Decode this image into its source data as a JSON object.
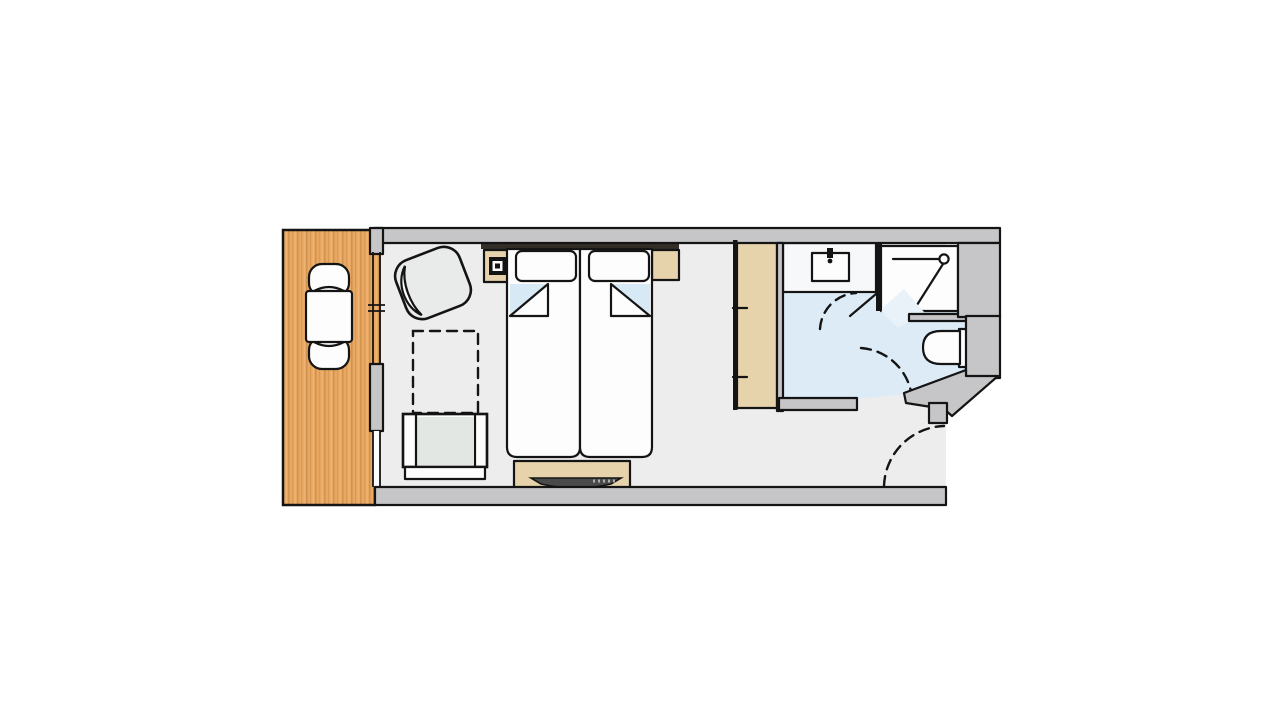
{
  "canvas": {
    "width": 1280,
    "height": 720,
    "background": "#ffffff"
  },
  "colors": {
    "wall": "#c6c6c8",
    "wood": "#e9a862",
    "wood_stripe": "#d09350",
    "wood_light": "#f0b272",
    "room_floor": "#ededee",
    "bathroom_floor": "#dcebf6",
    "furniture_tan": "#e7d3ab",
    "seat_gray": "#e3e7e4",
    "armchair_gray": "#e9ebea",
    "blanket_blue": "#d8e9f6",
    "door_swing_pale": "#e9f2f9",
    "outline_ink": "#141414",
    "fixture_white": "#fdfdfe",
    "tv_dark": "#4a4a4a",
    "headboard_dark": "#332e28",
    "vanity_top": "#f6f8fa"
  },
  "rooms": [
    {
      "id": "balcony",
      "label": "balcony with wood decking"
    },
    {
      "id": "bedroom",
      "label": "bedroom / living area"
    },
    {
      "id": "bathroom",
      "label": "bathroom"
    },
    {
      "id": "entry-hall",
      "label": "entry hallway"
    }
  ],
  "furniture": [
    "balcony-table",
    "balcony-chair-top",
    "balcony-chair-bottom",
    "armchair",
    "fold-out-footprint",
    "lounge-chair",
    "nightstand-left",
    "nightstand-right",
    "headboard-bar",
    "pillow-left",
    "pillow-right",
    "bed-left",
    "bed-right",
    "tv-sideboard",
    "television",
    "wardrobe",
    "vanity-counter",
    "wash-basin",
    "shower",
    "toilet"
  ],
  "openings": [
    "balcony-window",
    "balcony-door",
    "bathroom-door-swing",
    "shower-door-swing",
    "entry-door-swing"
  ]
}
